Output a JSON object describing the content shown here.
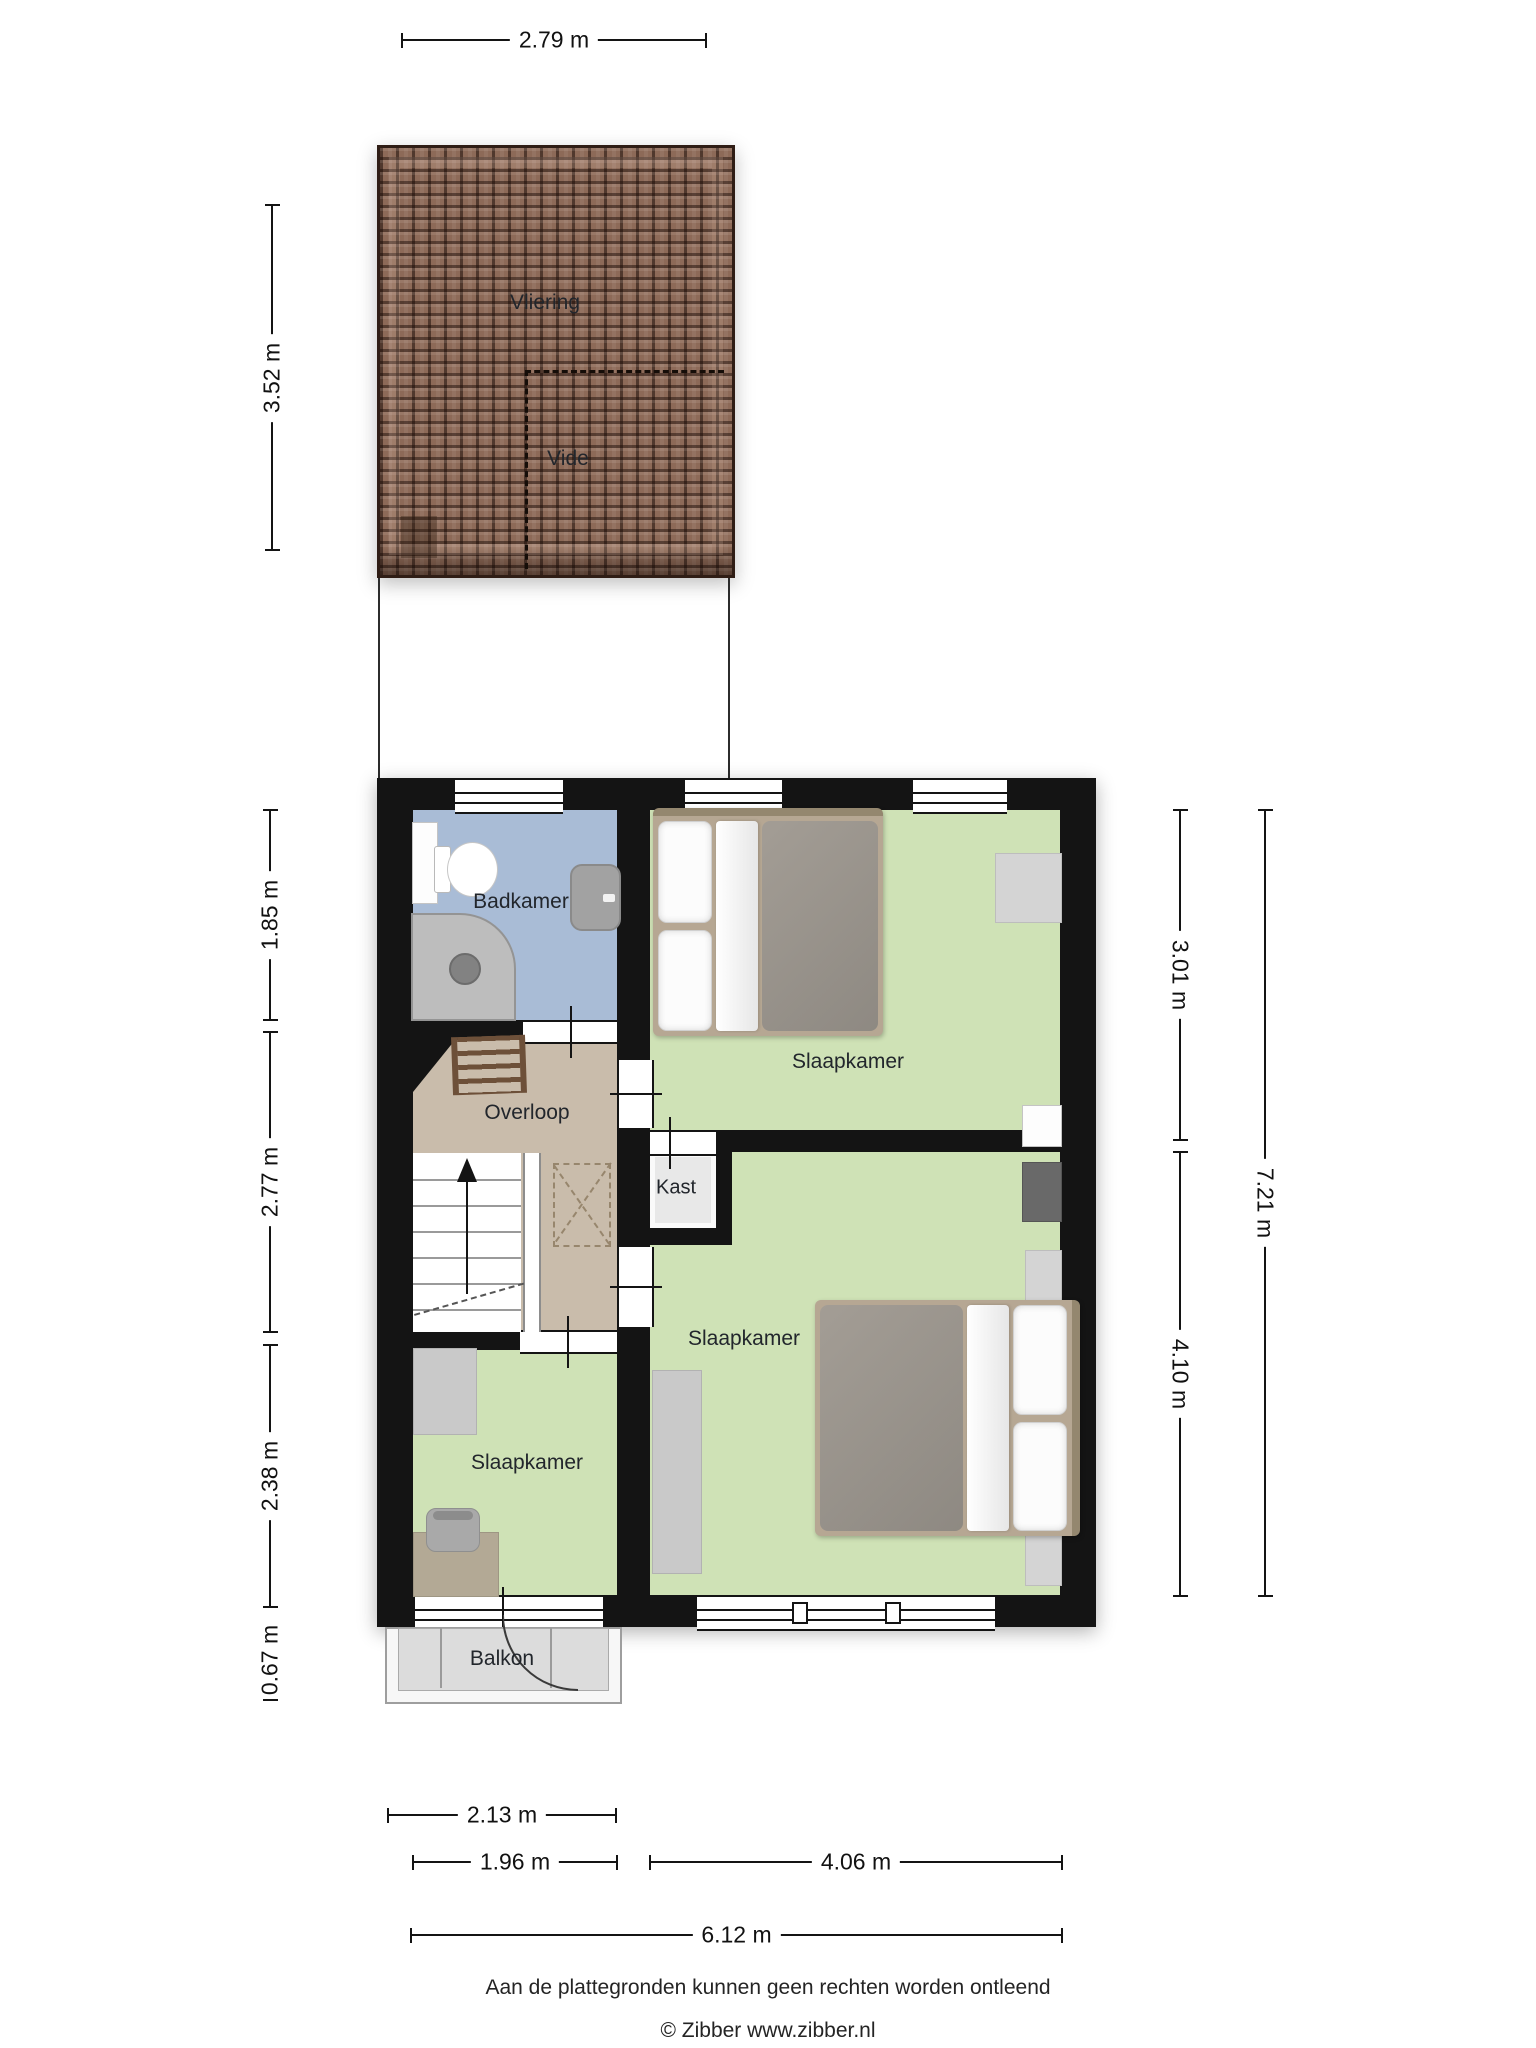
{
  "page": {
    "type": "floorplan-verdieping"
  },
  "rooms": {
    "vliering": "Vliering",
    "vide": "Vide",
    "badkamer": "Badkamer",
    "overloop": "Overloop",
    "slaapkamer_top": "Slaapkamer",
    "slaapkamer_groot": "Slaapkamer",
    "slaapkamer_klein": "Slaapkamer",
    "kast": "Kast",
    "balkon": "Balkon"
  },
  "dimensions": {
    "attic_width": "2.79 m",
    "attic_height": "3.52 m",
    "badkamer_height": "1.85 m",
    "overloop_height": "2.77 m",
    "slaapkamer_klein_height": "2.38 m",
    "balkon_height": "0.67 m",
    "slaapkamer_top_height": "3.01 m",
    "slaapkamer_groot_height": "4.10 m",
    "totaal_hoogte": "7.21 m",
    "balkon_width": "2.13 m",
    "links_width": "1.96 m",
    "rechts_width": "4.06 m",
    "totaal_breedte": "6.12 m"
  },
  "footer": {
    "disclaimer": "Aan de plattegronden kunnen geen rechten worden ontleend",
    "copyright": "© Zibber www.zibber.nl"
  },
  "colors": {
    "roof": "#8d6a58",
    "roof-line": "#2f1d15",
    "wall": "#141414",
    "badkamer": "#a9bcd6",
    "overloop": "#c9bcab",
    "bedroom": "#cfe2b6",
    "kast": "#e8e8e8",
    "balkon": "#dcdcdc",
    "wood": "#6d5039"
  }
}
